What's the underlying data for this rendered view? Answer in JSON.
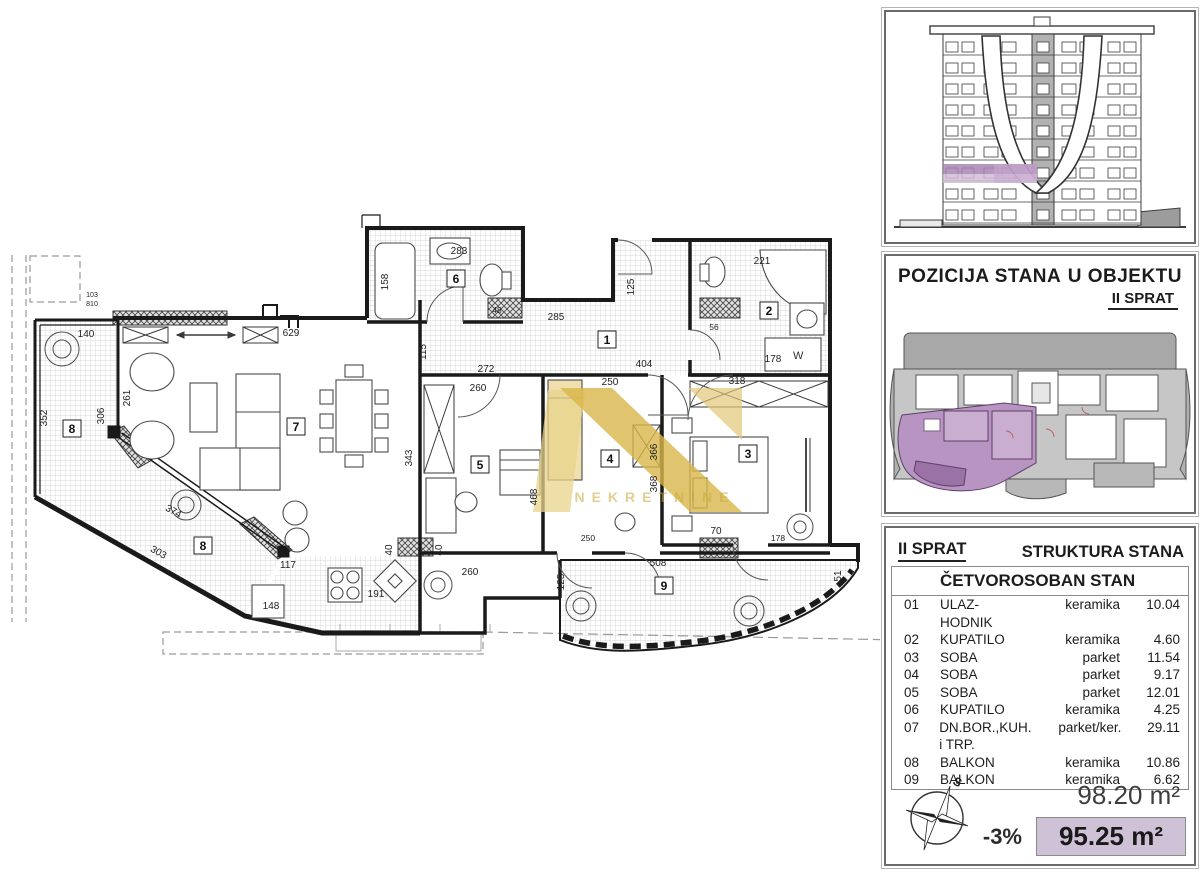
{
  "colors": {
    "highlight_purple": "#b794c1",
    "highlight_purple_dark": "#9a72a6",
    "net_area_bg": "#cfc2d6",
    "watermark_gold": "#d4af37",
    "plan_line": "#1a1a1a"
  },
  "plan": {
    "room_labels": [
      "1",
      "2",
      "3",
      "4",
      "5",
      "6",
      "7",
      "8",
      "8",
      "9"
    ],
    "dims": [
      "140",
      "352",
      "306",
      "261",
      "629",
      "283",
      "158",
      "285",
      "115",
      "272",
      "260",
      "250",
      "404",
      "318",
      "221",
      "125",
      "178",
      "468",
      "366",
      "368",
      "70",
      "508",
      "51",
      "125",
      "303",
      "374",
      "117",
      "148",
      "191",
      "260",
      "40",
      "40",
      "103",
      "810",
      "250",
      "56",
      "48",
      "178",
      "343"
    ],
    "watermark_text": "NEKRETNINE",
    "washer_label": "W"
  },
  "position_panel": {
    "title_left": "POZICIJA STANA",
    "title_right": "U OBJEKTU",
    "subtitle": "II SPRAT"
  },
  "structure_panel": {
    "floor": "II SPRAT",
    "title": "STRUKTURA STANA",
    "apartment_type": "ČETVOROSOBAN STAN",
    "rows": [
      {
        "num": "01",
        "name": "ULAZ-HODNIK",
        "material": "keramika",
        "area": "10.04"
      },
      {
        "num": "02",
        "name": "KUPATILO",
        "material": "keramika",
        "area": "4.60"
      },
      {
        "num": "03",
        "name": "SOBA",
        "material": "parket",
        "area": "11.54"
      },
      {
        "num": "04",
        "name": "SOBA",
        "material": "parket",
        "area": "9.17"
      },
      {
        "num": "05",
        "name": "SOBA",
        "material": "parket",
        "area": "12.01"
      },
      {
        "num": "06",
        "name": "KUPATILO",
        "material": "keramika",
        "area": "4.25"
      },
      {
        "num": "07",
        "name": "DN.BOR.,KUH. i TRP.",
        "material": "parket/ker.",
        "area": "29.11"
      },
      {
        "num": "08",
        "name": "BALKON",
        "material": "keramika",
        "area": "10.86"
      },
      {
        "num": "09",
        "name": "BALKON",
        "material": "keramika",
        "area": "6.62"
      }
    ]
  },
  "summary": {
    "gross_area": "98.20 m²",
    "reduction": "-3%",
    "net_area": "95.25 m²",
    "compass_label": "S"
  }
}
